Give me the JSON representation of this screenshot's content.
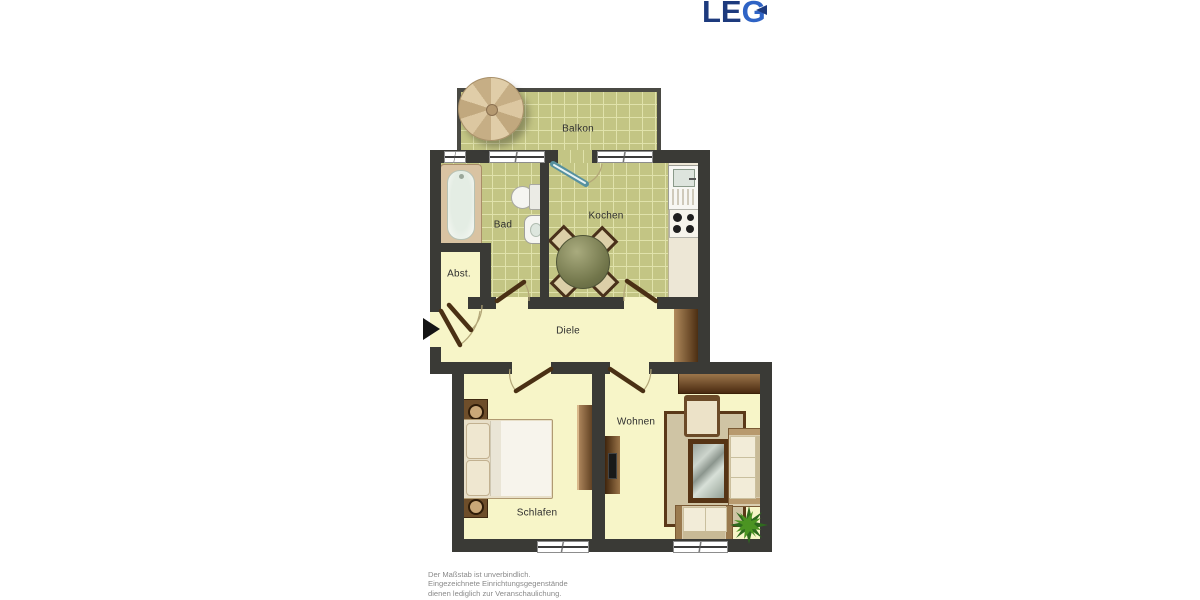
{
  "logo": {
    "le": "LE",
    "g": "G"
  },
  "rooms": {
    "balkon": "Balkon",
    "bad": "Bad",
    "kochen": "Kochen",
    "abst": "Abst.",
    "diele": "Diele",
    "schlafen": "Schlafen",
    "wohnen": "Wohnen"
  },
  "disclaimer": {
    "line1": "Der Maßstab ist unverbindlich.",
    "line2": "Eingezeichnete Einrichtungsgegenstände",
    "line3": "dienen lediglich zur Veranschaulichung."
  },
  "colors": {
    "logo_dark_blue": "#1d3a7d",
    "logo_light_blue": "#2e63c5",
    "wall": "#3a3a36",
    "tile_floor": "#c3c584",
    "tile_grout": "#e0e2ab",
    "plain_floor": "#f7f5c8",
    "wood_light": "#ab845a",
    "wood_dark": "#46290f",
    "door_leaf": "#4a3014",
    "balcony_door": "#57919f",
    "plant_green": "#2e6a1e",
    "disclaimer_text": "#8a8a8a"
  },
  "furniture_icons": [
    "parasol",
    "bathtub",
    "toilet",
    "wash-basin",
    "kitchen-sink",
    "stove",
    "dining-table",
    "dining-chair",
    "wardrobe",
    "double-bed",
    "nightstand",
    "tv-board",
    "sideboard",
    "rug",
    "armchair",
    "coffee-table",
    "sofa",
    "loveseat",
    "potted-plant",
    "entrance-arrow"
  ]
}
